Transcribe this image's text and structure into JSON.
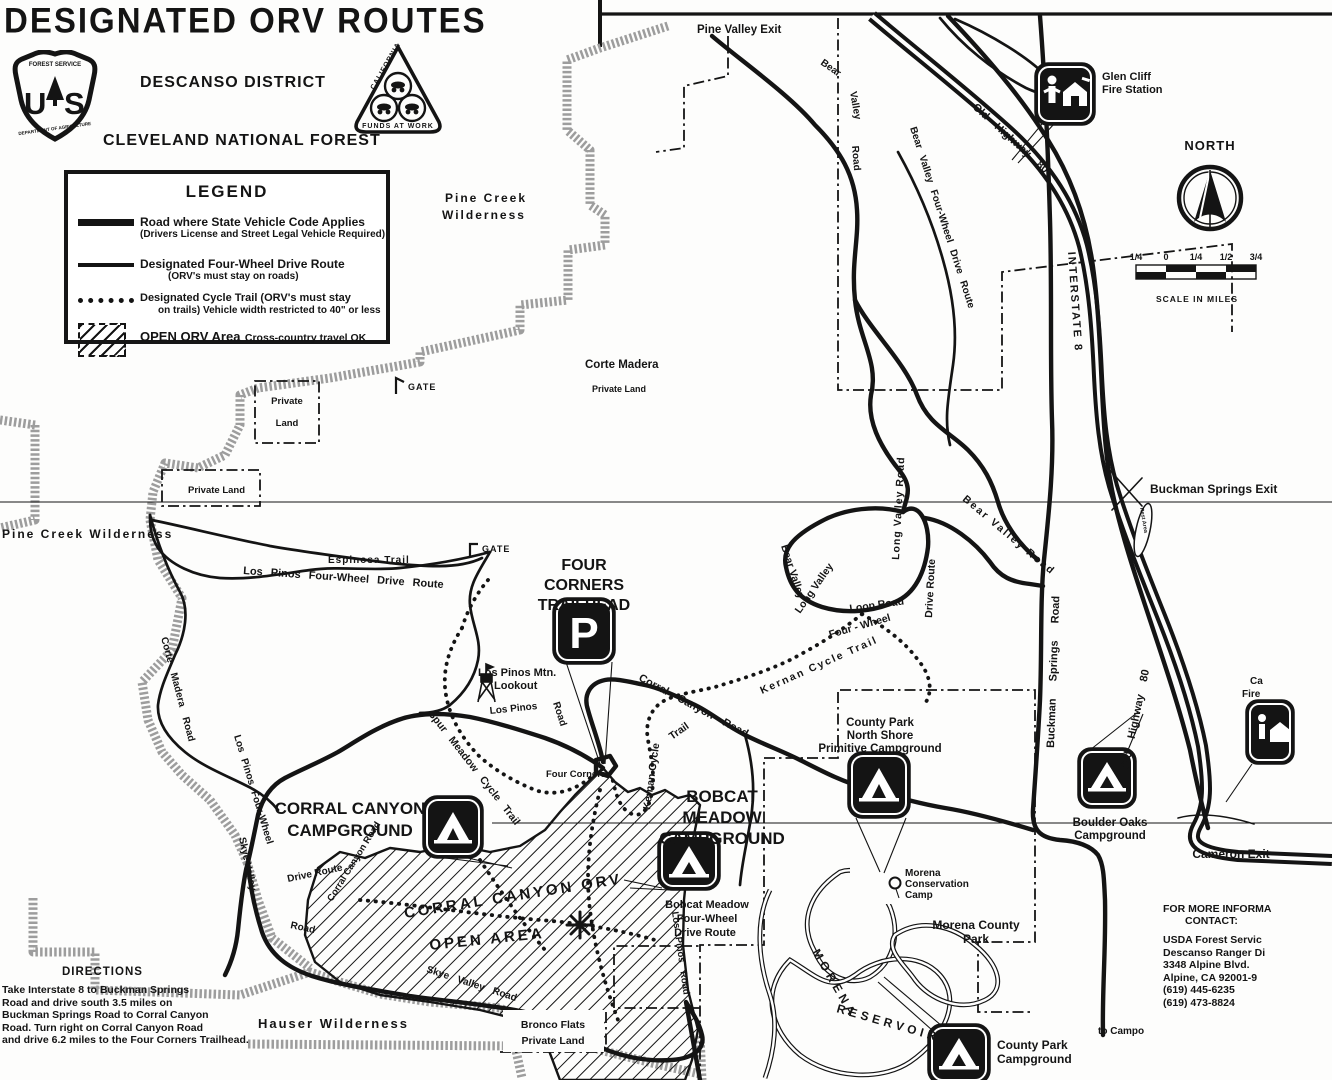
{
  "colors": {
    "ink": "#141414",
    "paper": "#fdfdfc",
    "stipple": "#9d9d9d"
  },
  "icons": {
    "campground": "tent-symbol-black-rounded-square",
    "parking": "letter-P-black-rounded-square",
    "fire_station": "person-and-house-black-rounded-square",
    "lookout": "tower-symbol",
    "north_arrow": "compass-circle-arrow",
    "gate": "gate-tick-symbol",
    "conservation_camp": "balloon-marker"
  },
  "header": {
    "title": "DESIGNATED ORV ROUTES",
    "district": "DESCANSO DISTRICT",
    "forest": "CLEVELAND NATIONAL FOREST",
    "usfs_shield": {
      "arc_top": "FOREST SERVICE",
      "letters": "US",
      "arc_bottom": "DEPARTMENT OF AGRICULTURE"
    },
    "ohv_triangle": {
      "side": "CALIFORNIA",
      "bottom": "FUNDS AT WORK"
    }
  },
  "legend": {
    "title": "LEGEND",
    "road_line1": "Road where State Vehicle Code Applies",
    "road_line2": "(Drivers License and Street Legal Vehicle Required)",
    "fwd_line1": "Designated Four-Wheel Drive Route",
    "fwd_line2": "(ORV's must stay on roads)",
    "cycle_line1": "Designated Cycle Trail (ORV's must stay",
    "cycle_line2": "on trails) Vehicle width restricted to 40\" or less",
    "open_label": "OPEN ORV Area",
    "open_sub": "Cross-country travel OK"
  },
  "north": {
    "label": "NORTH"
  },
  "scale": {
    "ticks": [
      "1/4",
      "0",
      "1/4",
      "1/2",
      "3/4"
    ],
    "caption": "SCALE IN MILES"
  },
  "directions": {
    "title": "DIRECTIONS",
    "lines": [
      "Take Interstate 8 to Buckman Springs",
      "Road and drive south 3.5 miles on",
      "Buckman Springs Road to Corral Canyon",
      "Road.  Turn right on Corral Canyon Road",
      "and drive 6.2 miles to the Four Corners Trailhead."
    ]
  },
  "contact": {
    "line1": "FOR MORE INFORMA",
    "line2": "CONTACT:",
    "line3": "USDA Forest Servic",
    "line4": "Descanso Ranger Di",
    "line5": "3348 Alpine Blvd.",
    "line6": "Alpine, CA 92001-9",
    "line7": "(619) 445-6235",
    "line8": "(619) 473-8824"
  },
  "map": {
    "pine_valley_exit": "Pine Valley Exit",
    "bear_top_1": "Bear",
    "bear_top_2": "Valley",
    "bear_top_3": "Road",
    "old_highway": "Old  Highway  80",
    "glen_cliff_1": "Glen Cliff",
    "glen_cliff_2": "Fire Station",
    "interstate": "INTERSTATE  8",
    "bear_4wd_top": "Bear  Valley  Four-Wheel  Drive  Route",
    "pine_creek_1": "Pine Creek",
    "pine_creek_2": "Wilderness",
    "corte_madera_1": "Corte Madera",
    "corte_madera_2": "Private Land",
    "gate": "GATE",
    "private_box_1": "Private",
    "private_box_2": "Land",
    "private_small": "Private Land",
    "pine_creek_left": "Pine Creek Wilderness",
    "espinosa": "Espinosa  Trail",
    "los_pinos_4wd": "Los Pinos  Four-Wheel  Drive  Route",
    "buckman_exit": "Buckman Springs Exit",
    "rest_area": "Rest Area",
    "long_valley_road": "Long  Valley  Road",
    "bear_valley_mid": "Bear  Valley  Road",
    "long_loop_1": "Long  Valley",
    "long_loop_2": "Loop  Road",
    "bear_loop_1": "Bear  Valley",
    "bear_loop_2": "Four - Wheel",
    "bear_loop_3": "Drive  Route",
    "kernan_mid": "Kernan  Cycle  Trail",
    "kernan_vert_1": "Kernan  Cycle",
    "kernan_vert_2": "Trail",
    "buckman_road": "Buckman   Springs   Road",
    "four_corners_1": "FOUR",
    "four_corners_2": "CORNERS",
    "four_corners_3": "TRAILHEAD",
    "parking_letter": "P",
    "lookout_1": "Los Pinos Mtn.",
    "lookout_2": "Lookout",
    "los_pinos_rd_1": "Los   Pinos",
    "los_pinos_rd_2": "Road",
    "corral_canyon_road": "Corral  Canyon  Road",
    "four_corners_pt": "Four Corners",
    "corral_cg_1": "CORRAL CANYON",
    "corral_cg_2": "CAMPGROUND",
    "spur_meadow": "Spur  Meadow  Cycle  Trail",
    "corte_madera_road": "Corte  Madera  Road",
    "los_pinos_left_1": "Los  Pinos  Four-Wheel",
    "los_pinos_left_2": "Drive  Route",
    "skye_1": "Skye  Valley",
    "skye_2": "Road",
    "skye_bottom": "Skye  Valley  Road",
    "orv_area_1": "CORRAL CANYON ORV",
    "orv_area_2": "OPEN AREA",
    "bobcat_1": "BOBCAT",
    "bobcat_2": "MEADOW",
    "bobcat_3": "CAMPGROUND",
    "bobcat_rt_1": "Bobcat Meadow",
    "bobcat_rt_2": "Four-Wheel",
    "bobcat_rt_3": "Drive Route",
    "los_pinos_road_vert": "Los  Pinos  Road",
    "ns_camp_1": "County Park",
    "ns_camp_2": "North Shore",
    "ns_camp_3": "Primitive Campground",
    "boulder_1": "Boulder Oaks",
    "boulder_2": "Campground",
    "cameron_exit": "Cameron Exit",
    "cam_fire_1": "Ca",
    "cam_fire_2": "Fire",
    "morena_cc_1": "Morena",
    "morena_cc_2": "Conservation",
    "morena_cc_3": "Camp",
    "mcp_1": "Morena County",
    "mcp_2": "Park",
    "reservoir_1": "MORENA",
    "reservoir_2": "RESERVOIR",
    "cp_cg_1": "County Park",
    "cp_cg_2": "Campground",
    "to_campo": "to Campo",
    "hauser": "Hauser  Wilderness",
    "bronco_1": "Bronco Flats",
    "bronco_2": "Private Land"
  }
}
